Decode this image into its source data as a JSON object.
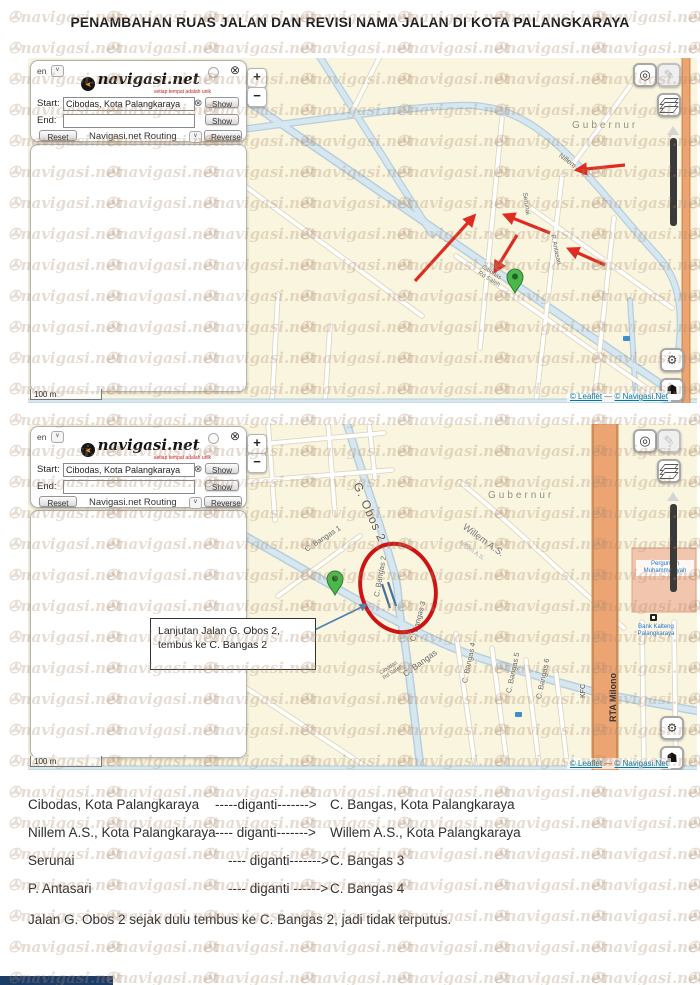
{
  "title": "PENAMBAHAN RUAS JALAN DAN REVISI NAMA JALAN DI KOTA PALANGKARAYA",
  "watermark": {
    "symbol": "✇",
    "text": "navigasi.net"
  },
  "icons": {
    "zoom_in": "+",
    "zoom_out": "−",
    "locate": "◎",
    "edit": "✎",
    "gear": "⚙",
    "flag": "☗",
    "chevron": "∨",
    "close": "⊗",
    "clear": "⊗"
  },
  "panel": {
    "lang": "en",
    "logo_arrow": "➤",
    "logo_text": "navigasi.net",
    "logo_tagline": "setiap tempat adalah unik",
    "start_label": "Start:",
    "start_value": "Cibodas, Kota Palangkaraya",
    "end_label": "End:",
    "end_value": "",
    "show_label": "Show",
    "reset_label": "Reset",
    "routing_label": "Navigasi.net Routing",
    "reverse_label": "Reverse"
  },
  "map_common": {
    "scale": "100 m",
    "attribution_leaflet": "© Leaflet",
    "attribution_sep": " — ",
    "attribution_site": "© Navigasi.Net"
  },
  "map1": {
    "labels": {
      "area": "Gubernur",
      "nillem": "Nillem A.S.",
      "serunai": "Serunai",
      "antasari": "P. Antasari",
      "cibodas": "Cibodas",
      "rdsaleh": "Rd Saleh"
    }
  },
  "map2": {
    "labels": {
      "area": "Gubernur",
      "gobos2": "G. Obos 2",
      "cbangas1": "C. Bangas 1",
      "willem": "Willem A.S.",
      "nillem": "Nillem A.S.",
      "cbangas2": "C. Bangas 2",
      "cbangas3": "C. Bangas 3",
      "cbangas": "C. Bangas",
      "cibodas": "Cibodas",
      "rdsaleh": "Rd Saleh",
      "cbangas4": "C. Bangas 4",
      "cbangas5": "C. Bangas 5",
      "cbangas6": "C. Bangas 6",
      "kfc": "KFC",
      "rta_milono": "RTA Milono",
      "bank_line1": "Bank Kalteng",
      "bank_line2": "Palangkaraya",
      "school_line1": "Perguruan",
      "school_line2": "Muhammadiyah"
    },
    "callout": {
      "line1": "Lanjutan Jalan G. Obos 2,",
      "line2": "tembus ke C. Bangas 2"
    }
  },
  "changes": [
    {
      "from": "Cibodas, Kota Palangkaraya",
      "arrow": "-----diganti------->",
      "to": "C. Bangas, Kota Palangkaraya"
    },
    {
      "from": "Nillem A.S., Kota Palangkaraya",
      "arrow": "---- diganti------->",
      "to": "Willem A.S., Kota Palangkaraya"
    },
    {
      "from": "Serunai",
      "arrow": "---- diganti------->",
      "to": "C. Bangas 3"
    },
    {
      "from": "P. Antasari",
      "arrow": "---- diganti ------>",
      "to": "C. Bangas 4"
    }
  ],
  "note": "Jalan G. Obos 2  sejak dulu tembus ke C. Bangas 2, jadi tidak terputus."
}
